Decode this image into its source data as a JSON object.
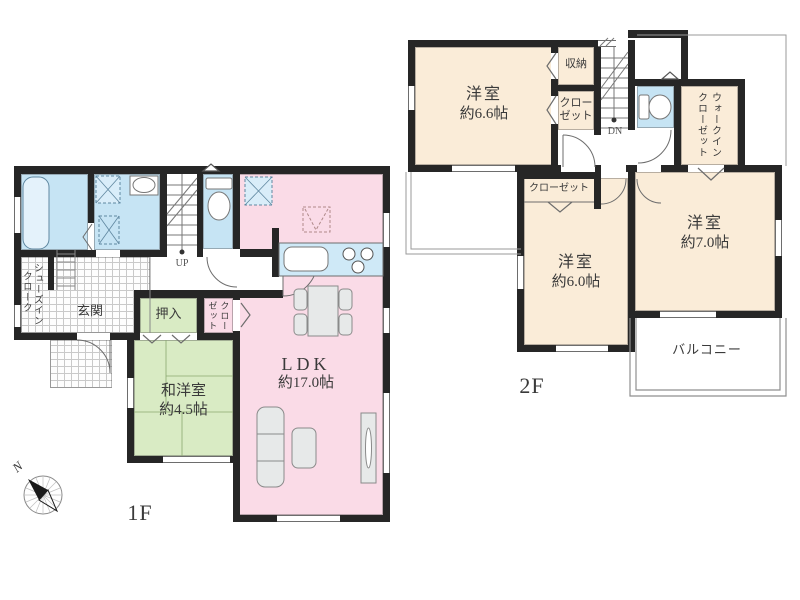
{
  "floor1": {
    "floor_label": "1F",
    "compass_north": "N",
    "stairs_label": "UP",
    "rooms": {
      "ldk_name": "LDK",
      "ldk_size": "約17.0帖",
      "washitsu_name": "和洋室",
      "washitsu_size": "約4.5帖",
      "genkan": "玄関",
      "oshiire": "押入",
      "closet_col1": "クロー",
      "closet_col2": "ゼット",
      "shoes_closet_col1": "シューズイン",
      "shoes_closet_col2": "クローク"
    }
  },
  "floor2": {
    "floor_label": "2F",
    "stairs_label": "DN",
    "rooms": {
      "bedroom_66_name": "洋室",
      "bedroom_66_size": "約6.6帖",
      "bedroom_60_name": "洋室",
      "bedroom_60_size": "約6.0帖",
      "bedroom_70_name": "洋室",
      "bedroom_70_size": "約7.0帖",
      "storage": "収納",
      "closet_upper_line1": "クロー",
      "closet_upper_line2": "ゼット",
      "closet_lower": "クローゼット",
      "wic_col1": "ウォークイン",
      "wic_col2": "クローゼット",
      "balcony": "バルコニー"
    }
  },
  "colors": {
    "wall": "#262626",
    "wet_area": "#c6e4f4",
    "ldk": "#fadbe7",
    "tatami": "#d9ebc4",
    "bedroom": "#faecd8"
  }
}
